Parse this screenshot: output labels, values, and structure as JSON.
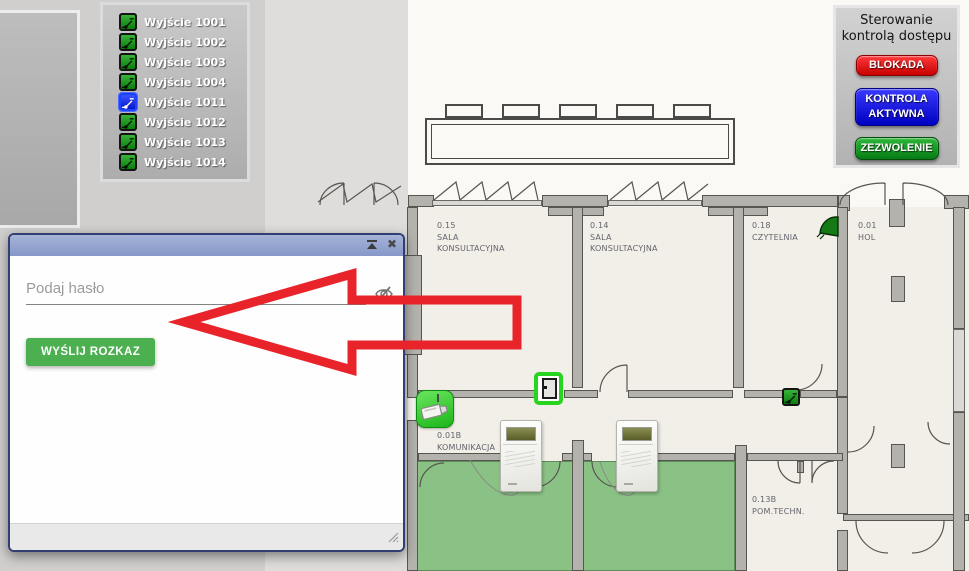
{
  "output_list": {
    "items": [
      {
        "label": "Wyjście 1001",
        "state": "on"
      },
      {
        "label": "Wyjście 1002",
        "state": "on"
      },
      {
        "label": "Wyjście 1003",
        "state": "on"
      },
      {
        "label": "Wyjście 1004",
        "state": "on"
      },
      {
        "label": "Wyjście 1011",
        "state": "selected"
      },
      {
        "label": "Wyjście 1012",
        "state": "on"
      },
      {
        "label": "Wyjście 1013",
        "state": "on"
      },
      {
        "label": "Wyjście 1014",
        "state": "on"
      }
    ]
  },
  "access_control_panel": {
    "title": "Sterowanie kontrolą dostępu",
    "buttons": [
      {
        "label": "BLOKADA",
        "color": "#d90000"
      },
      {
        "label": "KONTROLA AKTYWNA",
        "color": "#1212d9"
      },
      {
        "label": "ZEZWOLENIE",
        "color": "#0e8c1c"
      }
    ]
  },
  "command_dialog": {
    "password_placeholder": "Podaj hasło",
    "send_button_label": "WYŚLIJ ROZKAZ",
    "send_button_color": "#4caf50",
    "titlebar_color": "#8e9fca",
    "icons": {
      "collapse": "roll-up-triangle",
      "close": "✖",
      "password_visibility": "eye-off"
    }
  },
  "floor_plan": {
    "interior_color": "#f2efe8",
    "highlight_room_color": "#8ac285",
    "rooms": [
      {
        "id": "0.15",
        "name": "SALA KONSULTACYJNA"
      },
      {
        "id": "0.14",
        "name": "SALA KONSULTACYJNA"
      },
      {
        "id": "0.18",
        "name": "CZYTELNIA"
      },
      {
        "id": "0.01",
        "name": "HOL"
      },
      {
        "id": "0.01B",
        "name": "KOMUNIKACJA"
      },
      {
        "id": "0.13B",
        "name": "POM.TECHN."
      }
    ],
    "icons": [
      {
        "name": "camera-icon"
      },
      {
        "name": "door-icon"
      },
      {
        "name": "motion-sensor-icon"
      },
      {
        "name": "relay-icon"
      },
      {
        "name": "card-reader"
      },
      {
        "name": "card-reader"
      }
    ]
  },
  "annotation": {
    "type": "arrow-left",
    "color": "#e8242a"
  }
}
